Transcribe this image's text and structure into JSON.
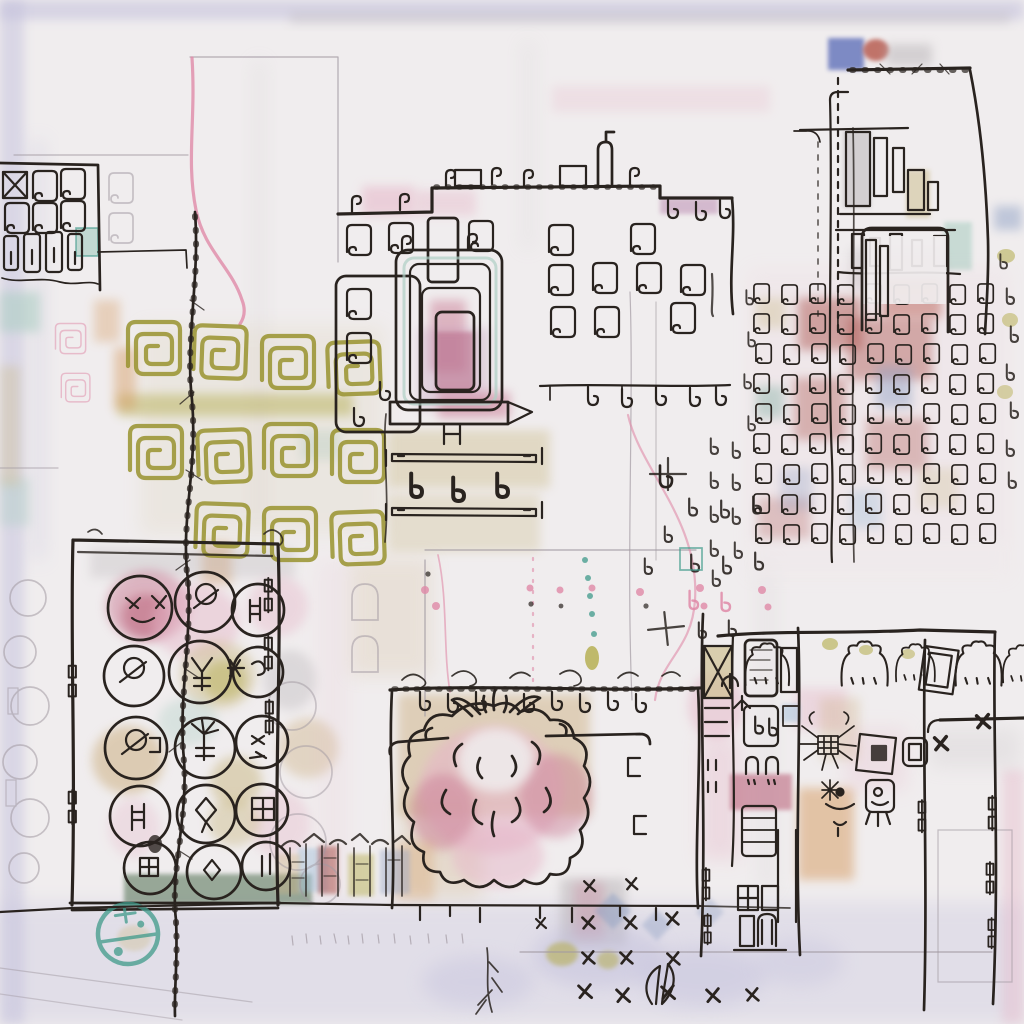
{
  "artwork": {
    "kind": "abstract ink and watercolor cityscape drawing, sketchbook style, no text",
    "regions": [
      {
        "name": "top-left-window-block",
        "desc": "black scribbled window glyphs with x-pane and barrel shapes"
      },
      {
        "name": "stitched-vertical-line",
        "desc": "long barbed ink line running from upper left to bottom"
      },
      {
        "name": "pink-contour-line",
        "desc": "wavy pink line descending from top"
      },
      {
        "name": "central-building",
        "desc": "row building with curled window glyphs, nested rectangle motif, hanging hooks, axle rails"
      },
      {
        "name": "olive-spiral-grid",
        "desc": "grid of olive-green rounded square spirals"
      },
      {
        "name": "top-right-tower",
        "desc": "tower with blue square, red dot, dashed edge and bar-chart-like windows"
      },
      {
        "name": "window-glyph-grid",
        "desc": "dense grid of small curl windows over red and blue bleeds with tall mast"
      },
      {
        "name": "center-mark-field",
        "desc": "scattered small glyphs, pink dots, teal dotted line, two plus crosses"
      },
      {
        "name": "left-grove-box",
        "desc": "large outlined box of circular tree blobs with symbols, dark green base band"
      },
      {
        "name": "teal-stamp",
        "desc": "teal circular stamp with cross and dots"
      },
      {
        "name": "bottom-center-topiary",
        "desc": "tan box with symmetric pink cloud topiary and leaf sprout"
      },
      {
        "name": "right-bottom-buildings",
        "desc": "towers with x-frame window, arched cloud shapes, hinge glyphs, doodles"
      },
      {
        "name": "mini-building-strip",
        "desc": "small blurry colorful row of buildings"
      },
      {
        "name": "ground-and-marks",
        "desc": "ground lines, rows of x marks, root branch, leaf sprout"
      }
    ],
    "media": {
      "ground": "paper",
      "line": "ink",
      "color": "watercolor"
    }
  },
  "palette": {
    "paper": "#f0edee",
    "lavender": "#c2c0dc",
    "ink": "#29231f",
    "pencil": "#a29aa2",
    "pink_line": "#e08aa8",
    "olive_ink": "#99932f",
    "gray_wash": "#b7b2b6",
    "pink_wash": "#e6b6c8",
    "rose": "#cb7e96",
    "deep_rose": "#b85b75",
    "mauve": "#bd8fb4",
    "maroon": "#a84c44",
    "red": "#b5544a",
    "orange": "#d59a5e",
    "tan": "#cdb184",
    "khaki": "#cfc093",
    "olive_wash": "#b3ab4a",
    "teal": "#6fa697",
    "pale_teal": "#aecfc4",
    "teal_stamp": "#3f9a8a",
    "dark_green": "#5d7a5e",
    "blue": "#6b79bd",
    "slate_blue": "#8fa0c4",
    "light_blue": "#a9c4dd"
  }
}
